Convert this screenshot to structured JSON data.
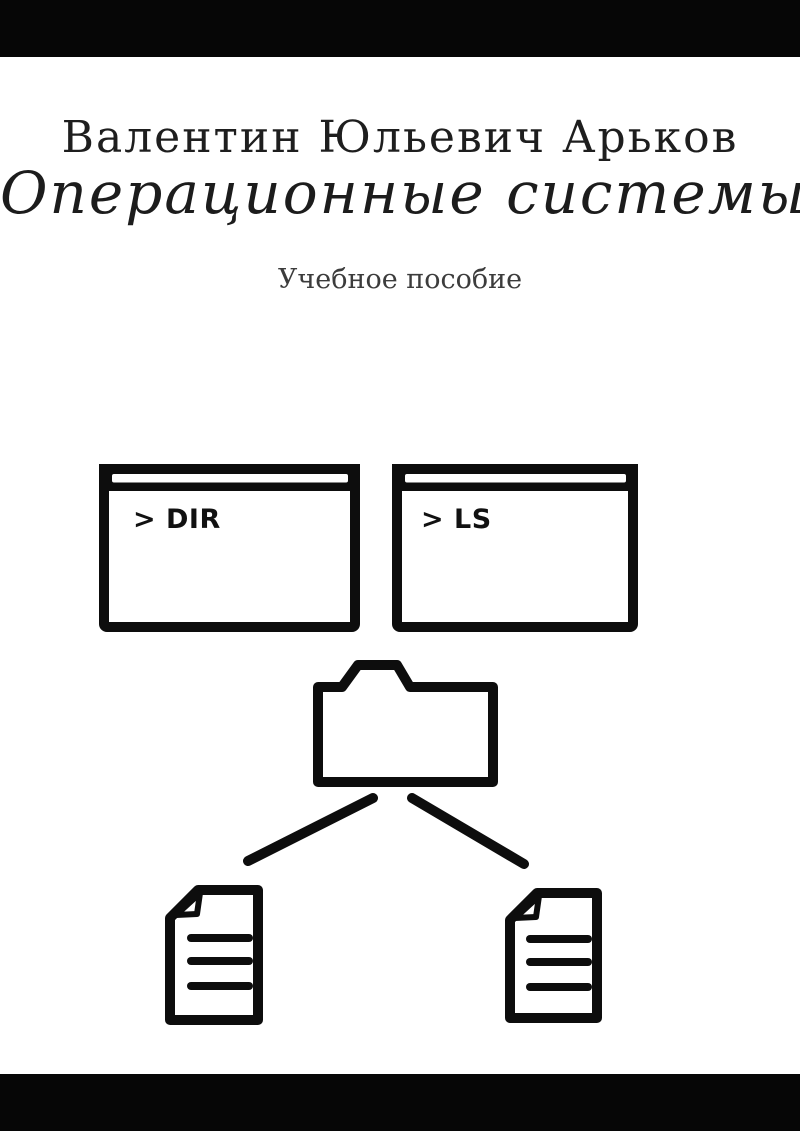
{
  "cover": {
    "author": "Валентин Юльевич Арьков",
    "title": "Операционные системы",
    "subtitle": "Учебное пособие",
    "colors": {
      "band": "#060606",
      "ink": "#1e1e1e",
      "subtitle_ink": "#3c3c3c",
      "line_art": "#0d0d0d",
      "background": "#ffffff"
    }
  },
  "diagram": {
    "terminals": [
      {
        "command": "> DIR"
      },
      {
        "command": "> LS"
      }
    ],
    "icons": {
      "terminal_left": "terminal-window-icon",
      "terminal_right": "terminal-window-icon",
      "folder": "folder-icon",
      "document_left": "document-icon",
      "document_right": "document-icon"
    }
  }
}
